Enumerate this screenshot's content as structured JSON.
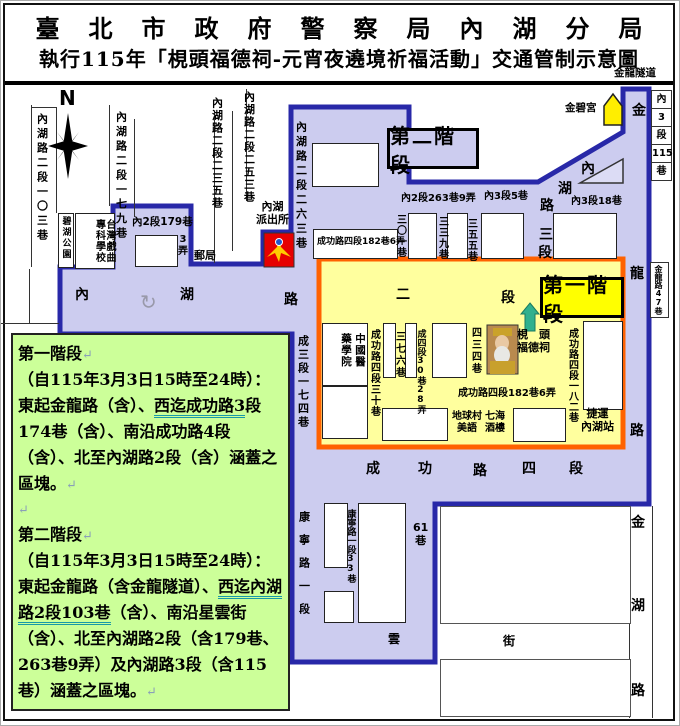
{
  "title": {
    "line1": "臺北市政府警察局內湖分局",
    "line2": "執行115年「梘頭福德祠-元宵夜遶境祈福活動」交通管制示意圖",
    "tunnel_note": "金龍隧道"
  },
  "legend": {
    "bg": "#ccff99",
    "paragraphs": [
      [
        {
          "t": "第一階段"
        },
        {
          "t": "↵",
          "mark": true
        }
      ],
      [
        {
          "t": "（自115年3月3日15時至24時）：東起金龍路（含）、"
        },
        {
          "t": "西迄成功路3",
          "u": true
        },
        {
          "t": "段174巷（含）、南沿成功路4段（含）、北至內湖路2段（含）涵蓋之區塊。"
        },
        {
          "t": "↵",
          "mark": true
        }
      ],
      [
        {
          "t": "↵",
          "mark": true
        }
      ],
      [
        {
          "t": "第二階段"
        },
        {
          "t": "↵",
          "mark": true
        }
      ],
      [
        {
          "t": "（自115年3月3日15時至24時）：東起金龍路（含金龍隧道）、"
        },
        {
          "t": "西迄內湖路2段103巷",
          "u": true
        },
        {
          "t": "（含）、南沿星雲街（含）、北至內湖路2段（含179巷、263巷9弄）及內湖路3段（含115巷）涵蓋之區塊。"
        },
        {
          "t": "↵",
          "mark": true
        }
      ]
    ]
  },
  "colors": {
    "purple_fill": "#ccccef",
    "purple_border": "#2828a8",
    "yellow_fill": "#ffff9e",
    "orange_border": "#ff6200",
    "stage1_bg": "#ffff00",
    "stage2_bg": "#ccccef",
    "green_bg": "#ccff99",
    "badge_red": "#e60000",
    "temple_yellow": "#ffee00",
    "arrow_teal": "#2fb08e"
  },
  "map": {
    "stage_labels": {
      "stage1": "第一階段",
      "stage2": "第二階段"
    },
    "zones": {
      "purple_points": "290,106 408,106 408,181 537,181 622,131 622,88 648,88 648,503 434,503 434,661 291,661 291,333 59,333 59,266 112,266 112,205 190,205 190,263 262,263 262,231 290,231",
      "yellow_rect": {
        "x": 318,
        "y": 258,
        "w": 304,
        "h": 188
      }
    },
    "right_column_cells": [
      "內",
      "3",
      "段",
      "115",
      "巷"
    ],
    "lane47_label": "金龍路47巷",
    "vertical_labels": [
      {
        "n": "road-neihu2-103",
        "t": "內湖路二段一〇三巷",
        "x": 35,
        "y": 112,
        "fs": 11,
        "ls": 3.5
      },
      {
        "n": "road-neihu2-179",
        "t": "內湖路二段一七九巷",
        "x": 114,
        "y": 110,
        "fs": 11,
        "ls": 3.5
      },
      {
        "n": "road-neihu2-235",
        "t": "內湖路二段二三五巷",
        "x": 210,
        "y": 96,
        "fs": 11,
        "ls": 1.5
      },
      {
        "n": "road-neihu2-253",
        "t": "內湖路二段二五三巷",
        "x": 242,
        "y": 90,
        "fs": 11,
        "ls": 1.5
      },
      {
        "n": "road-neihu2-263",
        "t": "內湖路二段二六三巷",
        "x": 294,
        "y": 120,
        "fs": 11,
        "ls": 3.5
      },
      {
        "n": "road-cheng3-174",
        "t": "成三段一七四巷",
        "x": 296,
        "y": 334,
        "fs": 11,
        "ls": 2.5
      },
      {
        "n": "road-cheng4-30",
        "t": "成功路四段三十巷",
        "x": 367,
        "y": 328,
        "fs": 10,
        "ls": 1
      },
      {
        "n": "lane-376",
        "t": "三七六巷",
        "x": 392,
        "y": 330,
        "fs": 10,
        "ls": 2
      },
      {
        "n": "road-cheng4-30-28",
        "t": "成四段30巷28弄",
        "x": 414,
        "y": 328,
        "fs": 9,
        "ls": 0
      },
      {
        "n": "lane-434",
        "t": "四三四巷",
        "x": 468,
        "y": 326,
        "fs": 10,
        "ls": 2
      },
      {
        "n": "road-cheng4-182",
        "t": "成功路四段一八二巷",
        "x": 565,
        "y": 327,
        "fs": 10,
        "ls": 0.5
      },
      {
        "n": "lane-301",
        "t": "三〇一巷",
        "x": 393,
        "y": 213,
        "fs": 10,
        "ls": 1
      },
      {
        "n": "lane-339",
        "t": "三三九巷",
        "x": 435,
        "y": 215,
        "fs": 10,
        "ls": 1
      },
      {
        "n": "lane-355",
        "t": "三五五巷",
        "x": 464,
        "y": 217,
        "fs": 10,
        "ls": 1
      },
      {
        "n": "road-kangning1",
        "t": "康寧路一段",
        "x": 297,
        "y": 510,
        "fs": 11,
        "ls": 12
      },
      {
        "n": "road-kangning1-33",
        "t": "康寧路一段33巷",
        "x": 344,
        "y": 508,
        "fs": 9,
        "ls": 0
      },
      {
        "n": "bihu-park-label",
        "t": "碧湖公園",
        "x": 59,
        "y": 215,
        "fs": 9,
        "ls": 2
      },
      {
        "n": "school-label",
        "t": "台灣戲曲專科學校",
        "x": 77,
        "y": 214,
        "fs": 10,
        "ls": 1,
        "w": 36,
        "h": 52
      },
      {
        "n": "hospital-label-col1",
        "t": "中國醫",
        "x": 353,
        "y": 332,
        "fs": 10.5,
        "ls": 1
      },
      {
        "n": "hospital-label-col2",
        "t": "藥學院",
        "x": 339,
        "y": 332,
        "fs": 10.5,
        "ls": 1
      }
    ],
    "horizontal_labels": [
      {
        "n": "post-office-label",
        "t": "郵局",
        "x": 193,
        "y": 249,
        "fs": 11
      },
      {
        "n": "lane-nei2-179-label",
        "t": "內2段179巷",
        "x": 131,
        "y": 215,
        "fs": 10.5
      },
      {
        "n": "alley-3-label",
        "t": "3\n弄",
        "x": 177,
        "y": 233,
        "fs": 10
      },
      {
        "n": "police-station-label",
        "t": "內湖\n派出所",
        "x": 255,
        "y": 200,
        "fs": 11
      },
      {
        "n": "jinbi-temple-label",
        "t": "金碧宮",
        "x": 564,
        "y": 101,
        "fs": 10.5
      },
      {
        "n": "lane-nei2-263-9",
        "t": "內2段263巷9弄",
        "x": 400,
        "y": 192,
        "fs": 10
      },
      {
        "n": "lane-nei3-5",
        "t": "內3段5巷",
        "x": 483,
        "y": 190,
        "fs": 10
      },
      {
        "n": "lane-nei3-18",
        "t": "內3段18巷",
        "x": 570,
        "y": 195,
        "fs": 10
      },
      {
        "n": "lane-cheng4-182-6-box",
        "t": "成功路四段182巷6弄",
        "x": 316,
        "y": 236,
        "fs": 9
      },
      {
        "n": "lane-cheng4-182-6",
        "t": "成功路四段182巷6弄",
        "x": 457,
        "y": 387,
        "fs": 10
      },
      {
        "n": "temple-name-label",
        "t": "梘　頭\n福德祠",
        "x": 516,
        "y": 328,
        "fs": 11
      },
      {
        "n": "diqiucun-label",
        "t": "地球村\n美語",
        "x": 451,
        "y": 410,
        "fs": 10
      },
      {
        "n": "qihai-label",
        "t": "七海\n酒樓",
        "x": 484,
        "y": 410,
        "fs": 10
      },
      {
        "n": "mrt-neihu-label",
        "t": "捷運\n內湖站",
        "x": 580,
        "y": 407,
        "fs": 11
      },
      {
        "n": "lane-61",
        "t": "61\n巷",
        "x": 412,
        "y": 521,
        "fs": 11
      },
      {
        "n": "road-yun",
        "t": "雲",
        "x": 387,
        "y": 632,
        "fs": 12
      },
      {
        "n": "road-jie",
        "t": "街",
        "x": 502,
        "y": 634,
        "fs": 12
      },
      {
        "n": "compass-n",
        "t": "N",
        "x": 58,
        "y": 86,
        "fs": 20
      },
      {
        "n": "roundabout-icon",
        "t": "↻",
        "x": 139,
        "y": 290,
        "fs": 20,
        "cls": "gray"
      }
    ],
    "road_chars": [
      {
        "n": "road-neihu-1",
        "t": "內",
        "x": 74,
        "y": 286
      },
      {
        "n": "road-neihu-2",
        "t": "湖",
        "x": 179,
        "y": 286
      },
      {
        "n": "road-neihu-3",
        "t": "路",
        "x": 283,
        "y": 291
      },
      {
        "n": "road-neihu-4",
        "t": "二",
        "x": 395,
        "y": 286
      },
      {
        "n": "road-neihu-5",
        "t": "段",
        "x": 500,
        "y": 289
      },
      {
        "n": "road-chenggong-1",
        "t": "成",
        "x": 365,
        "y": 460
      },
      {
        "n": "road-chenggong-2",
        "t": "功",
        "x": 417,
        "y": 460
      },
      {
        "n": "road-chenggong-3",
        "t": "路",
        "x": 472,
        "y": 462
      },
      {
        "n": "road-chenggong-4",
        "t": "四",
        "x": 521,
        "y": 460
      },
      {
        "n": "road-chenggong-5",
        "t": "段",
        "x": 568,
        "y": 460
      },
      {
        "n": "road-jinlong-1",
        "t": "金",
        "x": 631,
        "y": 102
      },
      {
        "n": "road-jinlong-2",
        "t": "龍",
        "x": 629,
        "y": 265
      },
      {
        "n": "road-jinlong-3",
        "t": "路",
        "x": 629,
        "y": 422
      },
      {
        "n": "road-jinhu-1",
        "t": "金",
        "x": 630,
        "y": 514
      },
      {
        "n": "road-jinhu-2",
        "t": "湖",
        "x": 630,
        "y": 597
      },
      {
        "n": "road-jinhu-3",
        "t": "路",
        "x": 630,
        "y": 682
      },
      {
        "n": "road-neihu3-1",
        "t": "內",
        "x": 580,
        "y": 160
      },
      {
        "n": "road-neihu3-2",
        "t": "湖",
        "x": 557,
        "y": 180
      },
      {
        "n": "road-neihu3-3",
        "t": "路",
        "x": 539,
        "y": 197
      },
      {
        "n": "road-neihu3-4",
        "t": "三",
        "x": 538,
        "y": 226
      },
      {
        "n": "road-neihu3-5",
        "t": "段",
        "x": 537,
        "y": 244
      }
    ],
    "buildings": [
      {
        "n": "bihu-park-box",
        "x": 57,
        "y": 212,
        "w": 16,
        "h": 55
      },
      {
        "n": "school-box",
        "x": 74,
        "y": 212,
        "w": 40,
        "h": 56
      },
      {
        "n": "building-179",
        "x": 134,
        "y": 234,
        "w": 43,
        "h": 32
      },
      {
        "n": "building-upper-lobe",
        "x": 311,
        "y": 142,
        "w": 67,
        "h": 44
      },
      {
        "n": "box-cheng4-182-6",
        "x": 312,
        "y": 228,
        "w": 85,
        "h": 30
      },
      {
        "n": "lane-strip-301",
        "x": 407,
        "y": 212,
        "w": 29,
        "h": 46
      },
      {
        "n": "lane-strip-339",
        "x": 446,
        "y": 212,
        "w": 21,
        "h": 46
      },
      {
        "n": "lane-strip-355",
        "x": 480,
        "y": 212,
        "w": 43,
        "h": 46
      },
      {
        "n": "lane-strip-nei3-18",
        "x": 552,
        "y": 212,
        "w": 64,
        "h": 46
      },
      {
        "n": "hospital-box",
        "x": 321,
        "y": 322,
        "w": 46,
        "h": 63
      },
      {
        "n": "hospital-box-lower",
        "x": 321,
        "y": 385,
        "w": 46,
        "h": 53
      },
      {
        "n": "building-376-left",
        "x": 382,
        "y": 322,
        "w": 13,
        "h": 55
      },
      {
        "n": "building-376-right",
        "x": 404,
        "y": 322,
        "w": 12,
        "h": 55
      },
      {
        "n": "building-mid",
        "x": 431,
        "y": 322,
        "w": 35,
        "h": 55
      },
      {
        "n": "building-south-1",
        "x": 381,
        "y": 407,
        "w": 66,
        "h": 33
      },
      {
        "n": "building-south-2",
        "x": 512,
        "y": 407,
        "w": 53,
        "h": 34
      },
      {
        "n": "building-east",
        "x": 582,
        "y": 320,
        "w": 40,
        "h": 89
      },
      {
        "n": "building-kangning-1",
        "x": 323,
        "y": 502,
        "w": 24,
        "h": 65
      },
      {
        "n": "building-kangning-2",
        "x": 357,
        "y": 502,
        "w": 48,
        "h": 120
      },
      {
        "n": "building-kangning-3",
        "x": 323,
        "y": 590,
        "w": 30,
        "h": 32
      },
      {
        "n": "block-southeast-1",
        "x": 439,
        "y": 505,
        "w": 191,
        "h": 118,
        "cls": "thin"
      },
      {
        "n": "block-southeast-2",
        "x": 439,
        "y": 658,
        "w": 191,
        "h": 58,
        "cls": "thin"
      }
    ],
    "lines": [
      {
        "x": 30,
        "y": 104,
        "w": 1,
        "h": 162
      },
      {
        "x": 55,
        "y": 107,
        "w": 1,
        "h": 105
      },
      {
        "x": 108,
        "y": 104,
        "w": 1,
        "h": 101
      },
      {
        "x": 133,
        "y": 118,
        "w": 1,
        "h": 98
      },
      {
        "x": 213,
        "y": 110,
        "w": 1,
        "h": 152
      },
      {
        "x": 231,
        "y": 110,
        "w": 1,
        "h": 140
      },
      {
        "x": 245,
        "y": 88,
        "w": 1,
        "h": 112
      },
      {
        "x": 30,
        "y": 106,
        "w": 26,
        "h": 1
      },
      {
        "x": 28,
        "y": 268,
        "w": 1,
        "h": 54
      },
      {
        "x": 0,
        "y": 322,
        "w": 58,
        "h": 1
      },
      {
        "x": 628,
        "y": 505,
        "w": 1,
        "h": 212
      },
      {
        "x": 651,
        "y": 505,
        "w": 1,
        "h": 212
      },
      {
        "x": 338,
        "y": 322,
        "w": 1,
        "h": 63
      },
      {
        "x": 353,
        "y": 322,
        "w": 1,
        "h": 63
      }
    ]
  }
}
